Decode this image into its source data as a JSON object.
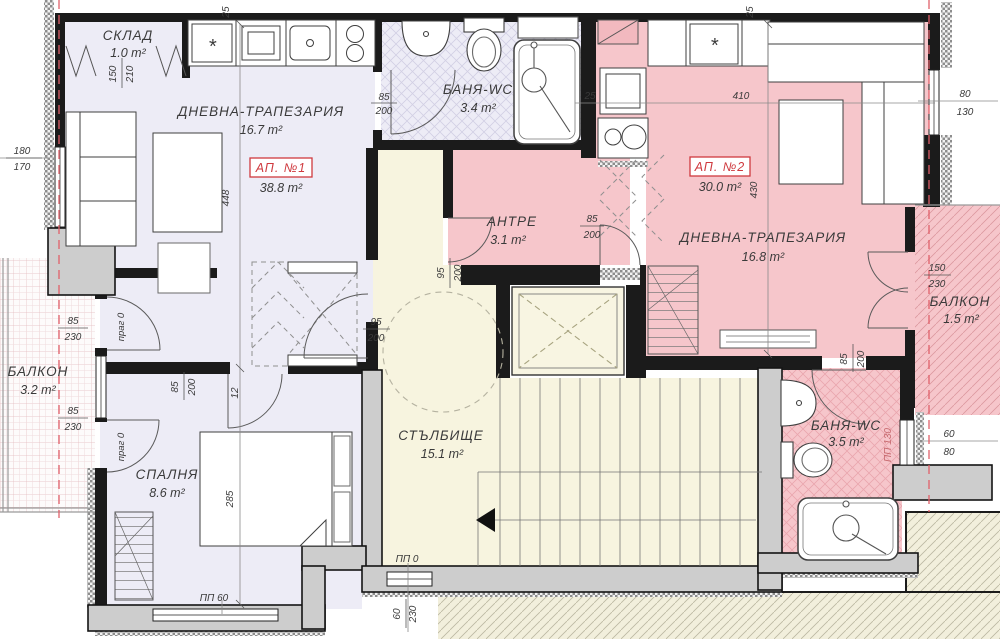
{
  "plan": {
    "apartments": {
      "ap1": {
        "label": "АП. №1",
        "area": "38.8 m²"
      },
      "ap2": {
        "label": "АП. №2",
        "area": "30.0 m²"
      }
    },
    "rooms": {
      "sklad": {
        "name": "СКЛАД",
        "area": "1.0 m²"
      },
      "living1": {
        "name": "ДНЕВНА-ТРАПЕЗАРИЯ",
        "area": "16.7 m²"
      },
      "bath1": {
        "name": "БАНЯ-WC",
        "area": "3.4 m²"
      },
      "antre": {
        "name": "АНТРЕ",
        "area": "3.1 m²"
      },
      "living2": {
        "name": "ДНЕВНА-ТРАПЕЗАРИЯ",
        "area": "16.8 m²"
      },
      "balcony2": {
        "name": "БАЛКОН",
        "area": "1.5 m²"
      },
      "balcony1": {
        "name": "БАЛКОН",
        "area": "3.2 m²"
      },
      "bedroom": {
        "name": "СПАЛНЯ",
        "area": "8.6 m²"
      },
      "stairs": {
        "name": "СТЪЛБИЩЕ",
        "area": "15.1 m²"
      },
      "bath2": {
        "name": "БАНЯ-WC",
        "area": "3.5 m²"
      }
    },
    "dims": {
      "top_25_left": "25",
      "top_25_right": "25",
      "kitchen2_25": "25",
      "living2_w": "410",
      "living1_h": "448",
      "living2_h": "430",
      "bed_l": "285",
      "win_left_w": "180",
      "win_left_h": "170",
      "sklad_door_w": "150",
      "sklad_door_h": "210",
      "bath1_door_w": "85",
      "bath1_door_h": "200",
      "balc1_top_w": "85",
      "balc1_top_h": "230",
      "balc1_bot_w": "85",
      "balc1_bot_h": "230",
      "hall_w": "85",
      "hall_h": "200",
      "hall_t": "12",
      "entry1_w": "95",
      "entry1_h": "200",
      "entry1b_w": "95",
      "entry1b_h": "200",
      "antre_w": "85",
      "antre_h": "200",
      "bath2_w": "85",
      "bath2_h": "200",
      "balc2_w": "150",
      "balc2_h": "230",
      "win_r_w": "80",
      "win_r_h": "130",
      "win_b2_w": "60",
      "win_b2_h": "80",
      "win_s_w": "60",
      "win_s_h": "230",
      "pp130": "ПП 130",
      "pp60": "ПП 60",
      "pp0": "ПП 0",
      "prag_top": "праг 0",
      "prag_bot": "праг 0"
    },
    "symbols": {
      "star1": "*",
      "star2": "*"
    },
    "colors": {
      "ap1_fill": "#edecf6",
      "ap2_fill": "#f6c6cb",
      "stair_fill": "#f7f4df",
      "wall_gray": "#cdcdcd",
      "accent_red": "#cf3a3f",
      "dash_red": "#e0606a"
    }
  }
}
